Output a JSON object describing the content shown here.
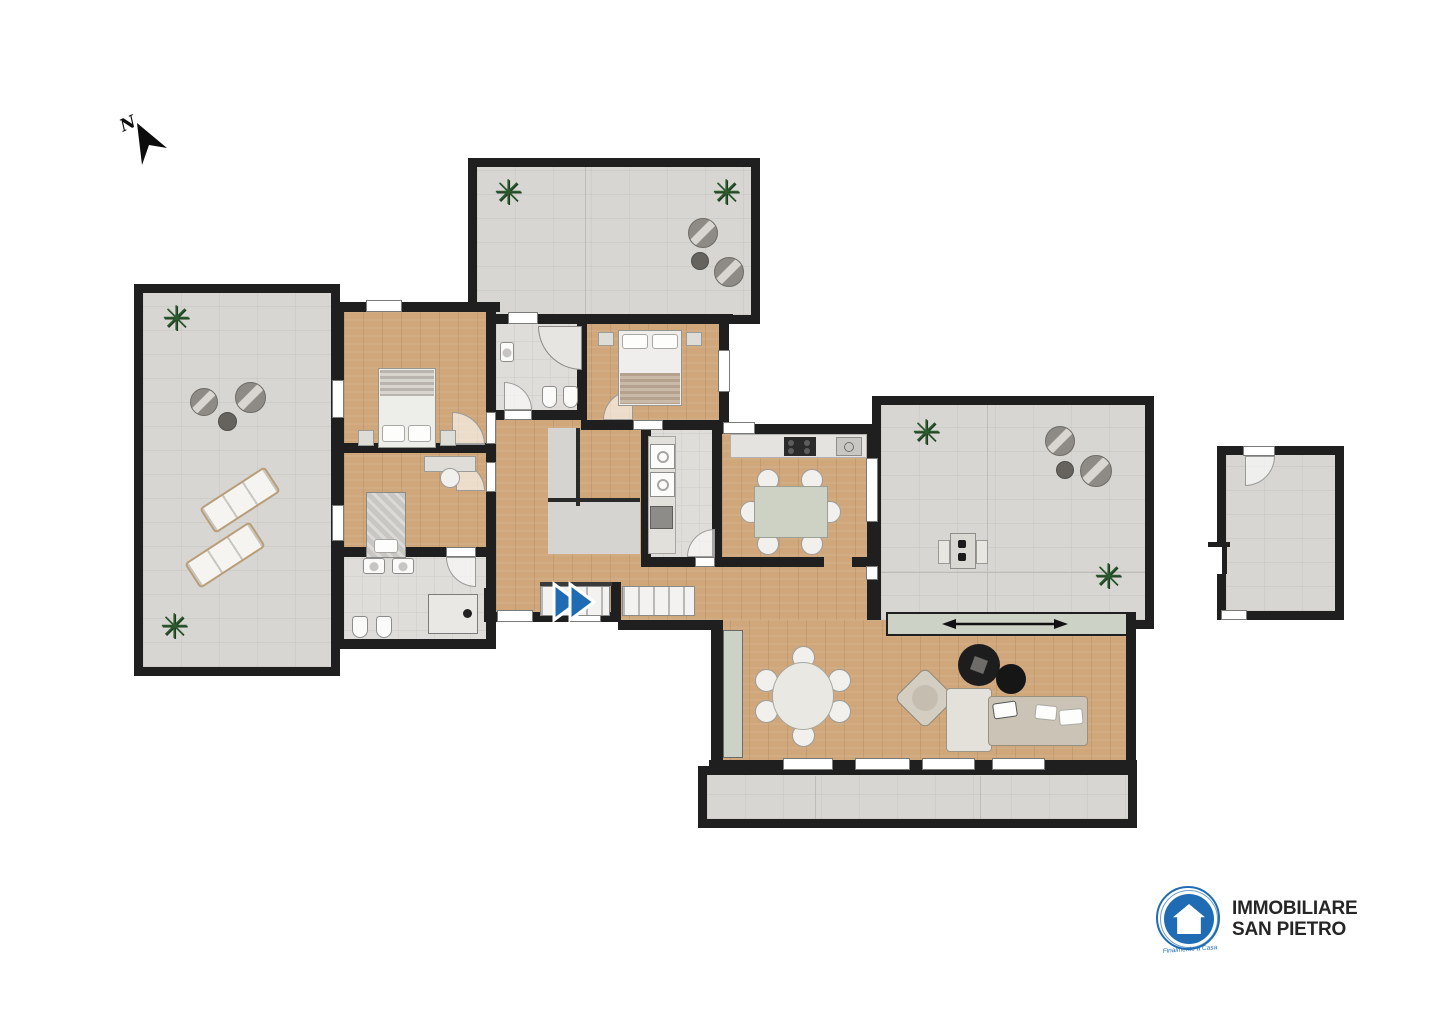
{
  "north": {
    "label": "N"
  },
  "logo": {
    "line1": "IMMOBILIARE",
    "line2": "SAN PIETRO",
    "tagline": "Finalmente a Casa"
  },
  "colors": {
    "wall": "#1f1f1f",
    "wood": "#cfa77b",
    "terrace": "#d7d6d2",
    "tile": "#deddd9",
    "glass": "#ccd2c6",
    "accent": "#1f6cb4",
    "ink": "#262626",
    "plant": "#2c5a2e"
  }
}
